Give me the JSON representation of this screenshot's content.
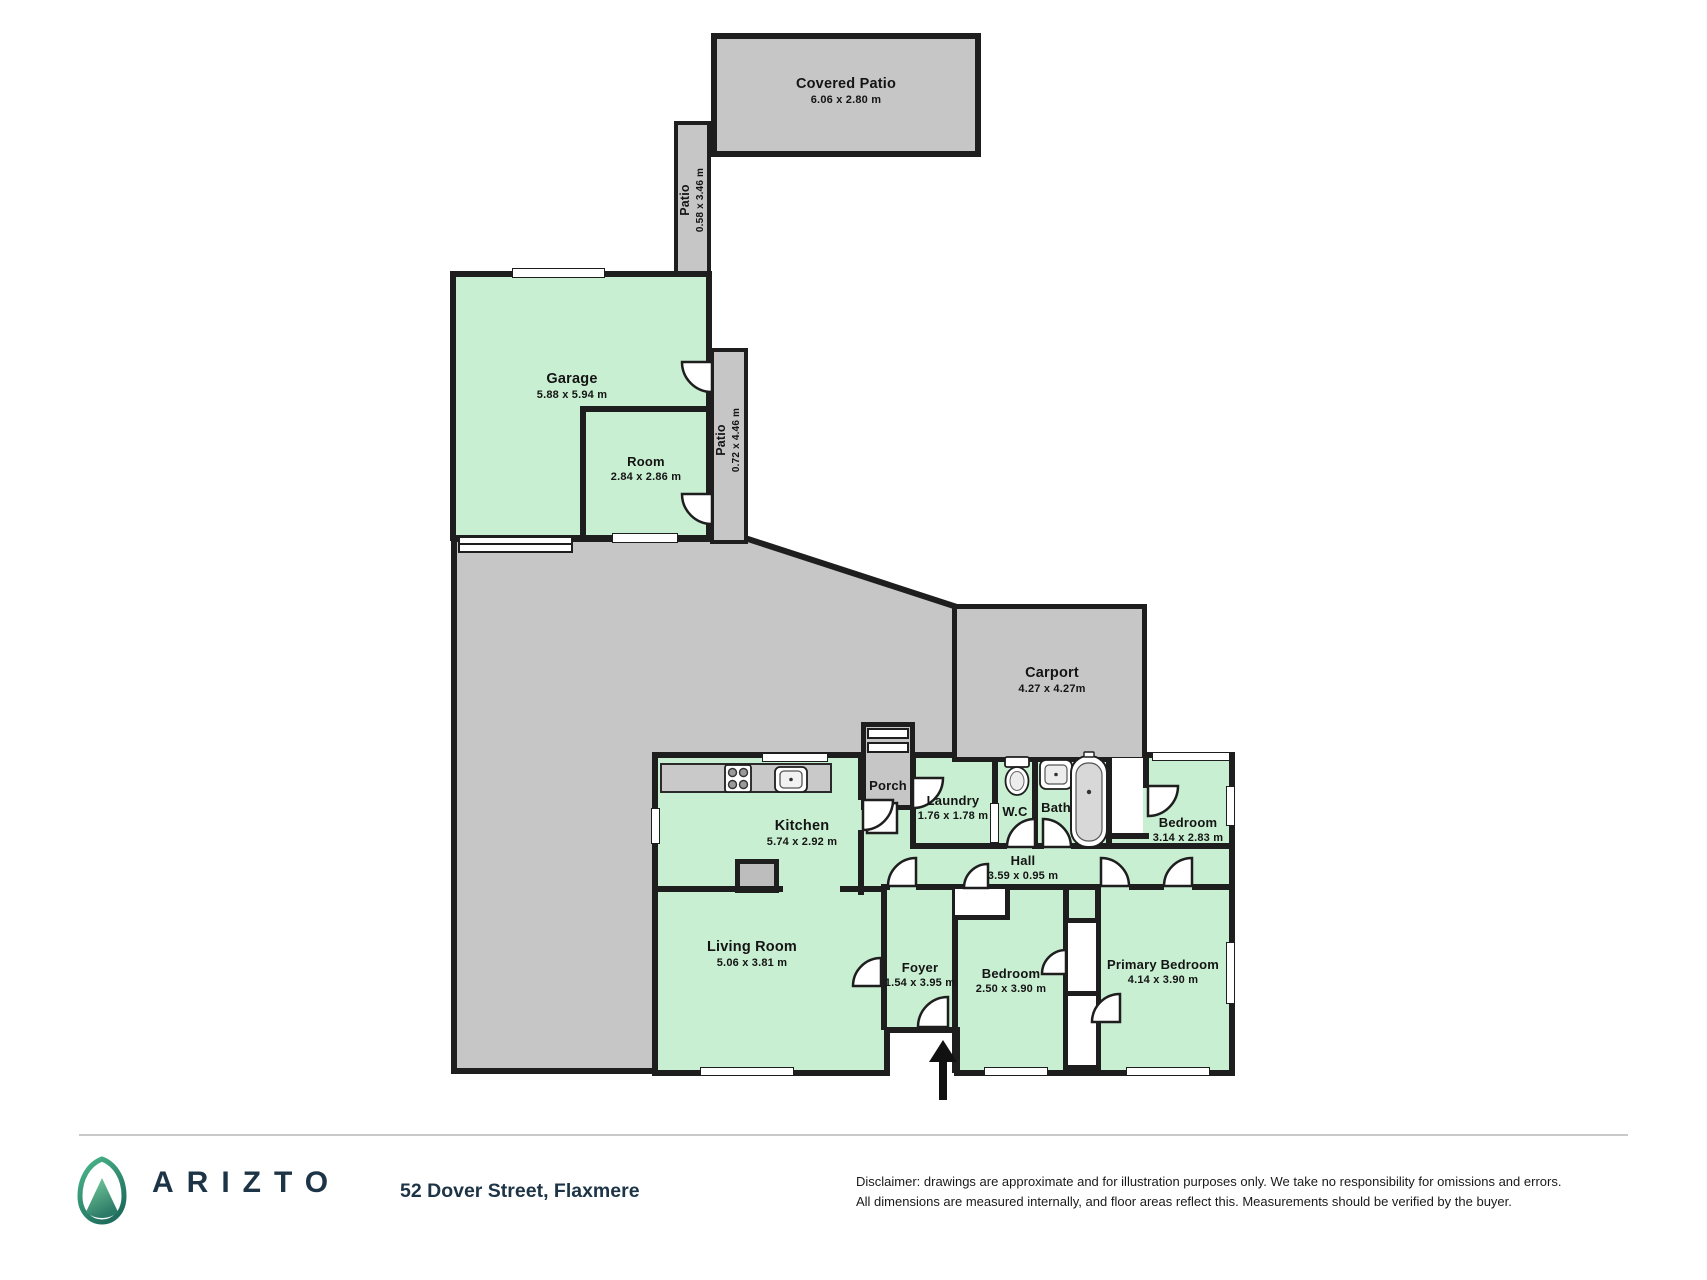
{
  "title": "Floor plan",
  "plan": {
    "rooms": [
      {
        "name": "Covered Patio",
        "dims": "6.06 x 2.80 m"
      },
      {
        "name": "Patio",
        "dims": "0.58 x 3.46 m"
      },
      {
        "name": "Garage",
        "dims": "5.88 x 5.94 m"
      },
      {
        "name": "Room",
        "dims": "2.84 x 2.86 m"
      },
      {
        "name": "Patio",
        "dims": "0.72 x 4.46 m"
      },
      {
        "name": "Carport",
        "dims": "4.27 x 4.27m"
      },
      {
        "name": "Porch",
        "dims": ""
      },
      {
        "name": "Kitchen",
        "dims": "5.74 x 2.92 m"
      },
      {
        "name": "Laundry",
        "dims": "1.76 x 1.78 m"
      },
      {
        "name": "W.C",
        "dims": ""
      },
      {
        "name": "Bath",
        "dims": ""
      },
      {
        "name": "Bedroom",
        "dims": "3.14 x 2.83 m"
      },
      {
        "name": "Hall",
        "dims": "3.59 x 0.95 m"
      },
      {
        "name": "Living Room",
        "dims": "5.06 x 3.81 m"
      },
      {
        "name": "Foyer",
        "dims": "1.54 x 3.95 m"
      },
      {
        "name": "Bedroom",
        "dims": "2.50 x 3.90 m"
      },
      {
        "name": "Primary Bedroom",
        "dims": "4.14 x 3.90 m"
      }
    ]
  },
  "footer": {
    "brand": "ARIZTO",
    "address": "52 Dover Street, Flaxmere",
    "disclaimer_line1": "Disclaimer: drawings are approximate and for illustration purposes only. We take no responsibility for omissions and errors.",
    "disclaimer_line2": "All dimensions are measured internally, and floor areas reflect this. Measurements should be verified by the buyer."
  },
  "colors": {
    "room_fill": "#c9efd2",
    "outdoor_fill": "#c5c6c5",
    "wall": "#1e1e1e",
    "brand_navy": "#1d3446"
  }
}
